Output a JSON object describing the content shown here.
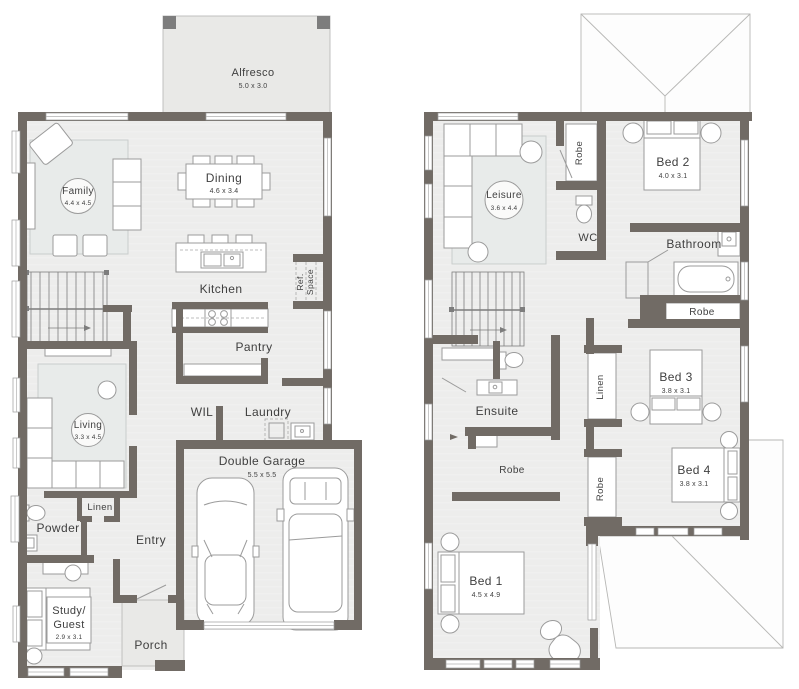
{
  "colors": {
    "wall": "#716b65",
    "floor": "#ededec",
    "alfresco_floor": "#e9e9e7",
    "furniture_line": "#9b9b9b",
    "text": "#3f3f3f"
  },
  "ground_floor": {
    "alfresco": {
      "name": "Alfresco",
      "dims": "5.0 x 3.0"
    },
    "family": {
      "name": "Family",
      "dims": "4.4 x 4.5"
    },
    "dining": {
      "name": "Dining",
      "dims": "4.6 x 3.4"
    },
    "kitchen": {
      "name": "Kitchen"
    },
    "ref_space": {
      "line1": "Ref.",
      "line2": "Space"
    },
    "pantry": {
      "name": "Pantry"
    },
    "wil": {
      "name": "WIL"
    },
    "laundry": {
      "name": "Laundry"
    },
    "living": {
      "name": "Living",
      "dims": "3.3 x 4.5"
    },
    "linen": {
      "name": "Linen"
    },
    "powder": {
      "name": "Powder"
    },
    "entry": {
      "name": "Entry"
    },
    "garage": {
      "name": "Double Garage",
      "dims": "5.5 x 5.5"
    },
    "study": {
      "line1": "Study/",
      "line2": "Guest",
      "dims": "2.9 x 3.1"
    },
    "porch": {
      "name": "Porch"
    }
  },
  "upper_floor": {
    "leisure": {
      "name": "Leisure",
      "dims": "3.6 x 4.4"
    },
    "robe_top": {
      "name": "Robe"
    },
    "bed2": {
      "name": "Bed 2",
      "dims": "4.0 x 3.1"
    },
    "wc": {
      "name": "WC"
    },
    "bathroom": {
      "name": "Bathroom"
    },
    "robe_bathroom": {
      "name": "Robe"
    },
    "linen": {
      "name": "Linen"
    },
    "bed3": {
      "name": "Bed 3",
      "dims": "3.8 x 3.1"
    },
    "ensuite": {
      "name": "Ensuite"
    },
    "robe_ensuite": {
      "name": "Robe"
    },
    "bed4": {
      "name": "Bed 4",
      "dims": "3.8 x 3.1"
    },
    "robe_bed4": {
      "name": "Robe"
    },
    "bed1": {
      "name": "Bed 1",
      "dims": "4.5 x 4.9"
    }
  }
}
